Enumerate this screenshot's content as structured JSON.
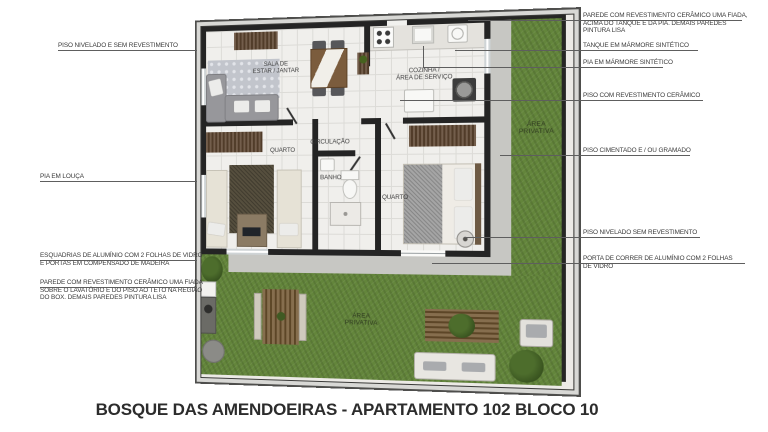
{
  "title": "BOSQUE DAS AMENDOEIRAS - APARTAMENTO 102 BLOCO 10",
  "plan": {
    "rooms": {
      "living": "SALA DE\nESTAR / JANTAR",
      "kitchen": "COZINHA /\nÁREA DE SERVIÇO",
      "bedroom1": "QUARTO",
      "hall": "CIRCULAÇÃO",
      "bath": "BANHO",
      "bedroom2": "QUARTO",
      "side_yard": "ÁREA\nPRIVATIVA",
      "garden": "ÁREA\nPRIVATIVA"
    }
  },
  "callouts": {
    "left": [
      {
        "text": "PISO NIVELADO E SEM REVESTIMENTO"
      },
      {
        "text": "PIA EM LOUÇA"
      },
      {
        "text": "ESQUADRIAS DE ALUMÍNIO COM 2 FOLHAS DE VIDRO\nE PORTAS EM COMPENSADO DE MADEIRA"
      },
      {
        "text": "PAREDE COM REVESTIMENTO CERÂMICO UMA FIADA\nSOBRE O LAVATÓRIO E DO PISO AO TETO NA REGIÃO\nDO BOX. DEMAIS PAREDES PINTURA LISA"
      }
    ],
    "right": [
      {
        "text": "PAREDE COM REVESTIMENTO CERÂMICO UMA FIADA,\nACIMA DO TANQUE E DA PIA. DEMAIS PAREDES\nPINTURA LISA"
      },
      {
        "text": "TANQUE EM MÁRMORE SINTÉTICO"
      },
      {
        "text": "PIA EM MÁRMORE SINTÉTICO"
      },
      {
        "text": "PISO COM REVESTIMENTO CERÂMICO"
      },
      {
        "text": "PISO CIMENTADO E / OU GRAMADO"
      },
      {
        "text": "PISO NIVELADO SEM REVESTIMENTO"
      },
      {
        "text": "PORTA DE CORRER DE ALUMÍNIO COM 2 FOLHAS\nDE VIDRO"
      }
    ]
  },
  "colors": {
    "grass": "#63853b",
    "wall": "#242424",
    "floor_tile": "#f0efec",
    "path": "#c7c7c3",
    "wood": "#5c442f",
    "label_text": "#3a3a3a"
  }
}
